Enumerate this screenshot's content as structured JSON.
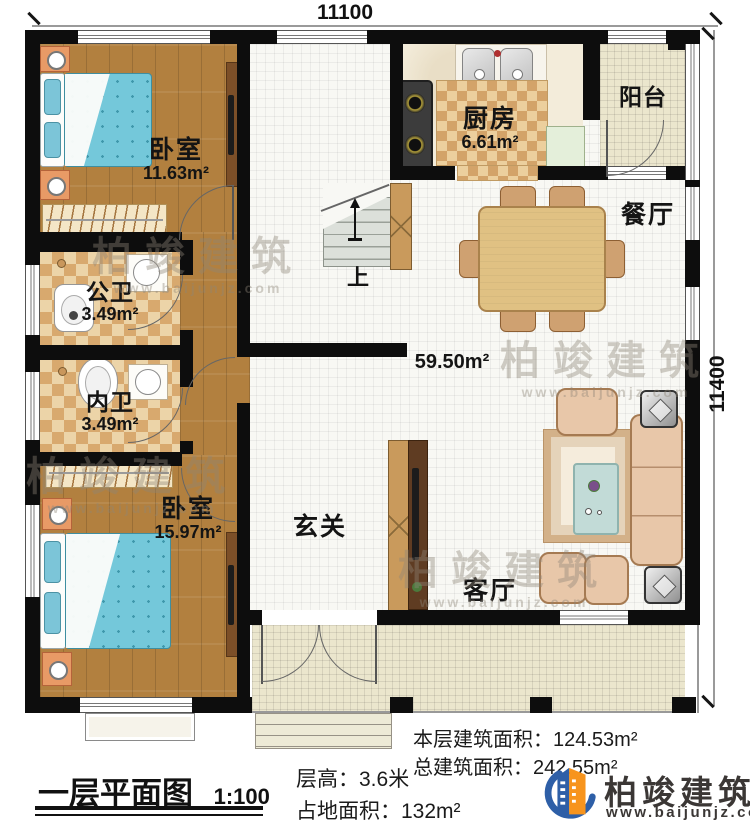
{
  "dimensions": {
    "top": "11100",
    "right": "11400"
  },
  "rooms": {
    "bedroom1": {
      "name": "卧室",
      "area": "11.63m²"
    },
    "kitchen": {
      "name": "厨房",
      "area": "6.61m²"
    },
    "balcony": {
      "name": "阳台"
    },
    "dining": {
      "name": "餐厅"
    },
    "public_bath": {
      "name": "公卫",
      "area": "3.49m²"
    },
    "inner_bath": {
      "name": "内卫",
      "area": "3.49m²"
    },
    "bedroom2": {
      "name": "卧室",
      "area": "15.97m²"
    },
    "foyer": {
      "name": "玄关"
    },
    "living": {
      "name": "客厅"
    },
    "hall_area": "59.50m²",
    "stairs_up": "上"
  },
  "footer": {
    "plan_title": "一层平面图",
    "scale": "1:100",
    "floor_height": "层高：3.6米",
    "ground_area": "占地面积：132m²",
    "this_floor_area": "本层建筑面积：124.53m²",
    "total_area": "总建筑面积：242.55m²"
  },
  "brand": {
    "name": "柏竣建筑",
    "website": "www.baijunjz.com"
  },
  "watermark": {
    "name": "柏竣建筑",
    "website": "www.baijunjz.com"
  },
  "colors": {
    "brand_blue": "#2e5fa7",
    "brand_orange": "#f7941d",
    "wall": "#0d0d0d"
  }
}
